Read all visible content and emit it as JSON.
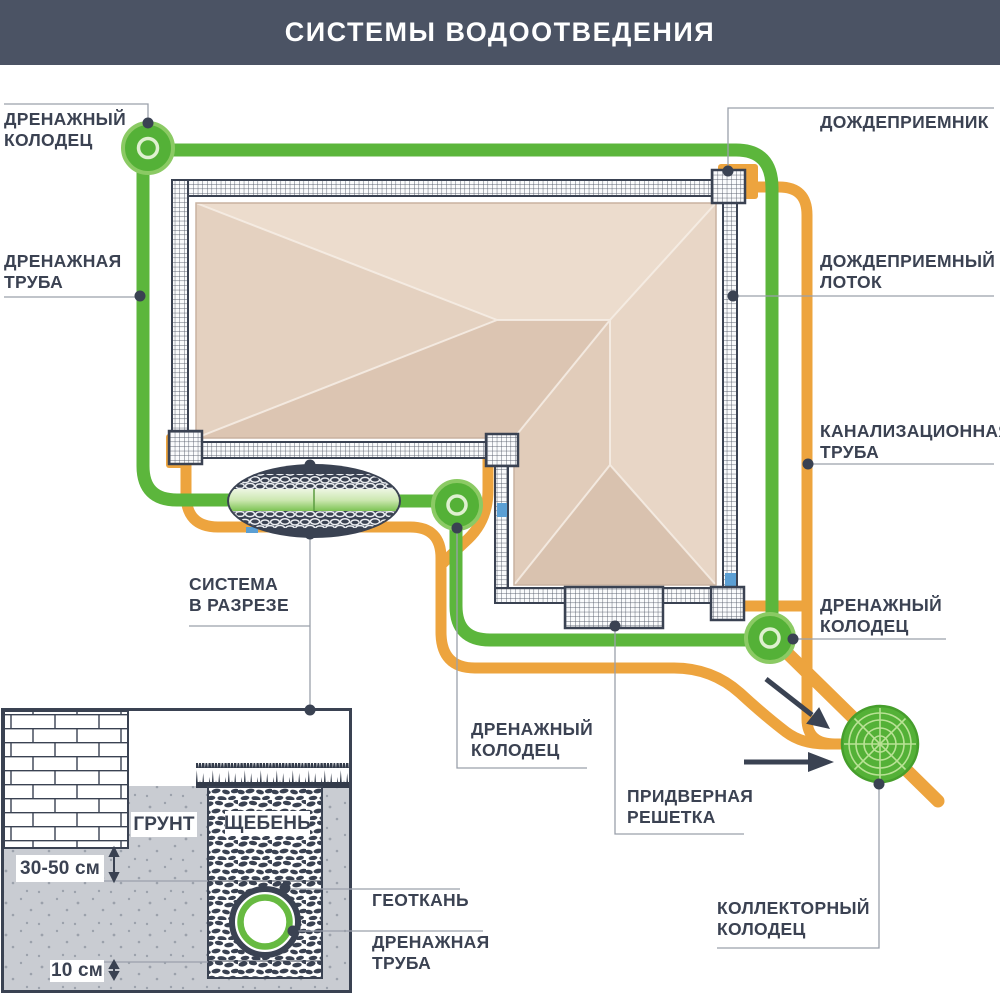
{
  "header": {
    "title": "СИСТЕМЫ ВОДООТВЕДЕНИЯ",
    "bg": "#4b5364"
  },
  "colors": {
    "drain_green": "#5cb63c",
    "well_green_fill": "#54b137",
    "well_green_rim": "#8bca64",
    "sewer_orange": "#eda43e",
    "dark_slate": "#3a4252",
    "roof_light": "#ecdccd",
    "roof_dark": "#dcc5b2",
    "soil_gray": "#c9ccd2",
    "water_blue": "#5b9fd4",
    "leader_gray": "#9aa0ab"
  },
  "labels": {
    "drainage_well_top_left": "ДРЕНАЖНЫЙ\nКОЛОДЕЦ",
    "drainage_pipe_left": "ДРЕНАЖНАЯ\nТРУБА",
    "rain_inlet": "ДОЖДЕПРИЕМНИК",
    "rain_tray": "ДОЖДЕПРИЕМНЫЙ\nЛОТОК",
    "sewer_pipe": "КАНАЛИЗАЦИОННАЯ\nТРУБА",
    "drainage_well_right": "ДРЕНАЖНЫЙ\nКОЛОДЕЦ",
    "system_in_section": "СИСТЕМА\nВ РАЗРЕЗЕ",
    "drainage_well_center": "ДРЕНАЖНЫЙ\nКОЛОДЕЦ",
    "door_grate": "ПРИДВЕРНАЯ\nРЕШЕТКА",
    "collector_well": "КОЛЛЕКТОРНЫЙ\nКОЛОДЕЦ",
    "geotextile": "ГЕОТКАНЬ",
    "drainage_pipe_section": "ДРЕНАЖНАЯ\nТРУБА"
  },
  "section_detail": {
    "soil": "ГРУНТ",
    "gravel": "ЩЕБЕНЬ",
    "depth_dimension": "30-50 см",
    "bottom_dimension": "10 см"
  }
}
